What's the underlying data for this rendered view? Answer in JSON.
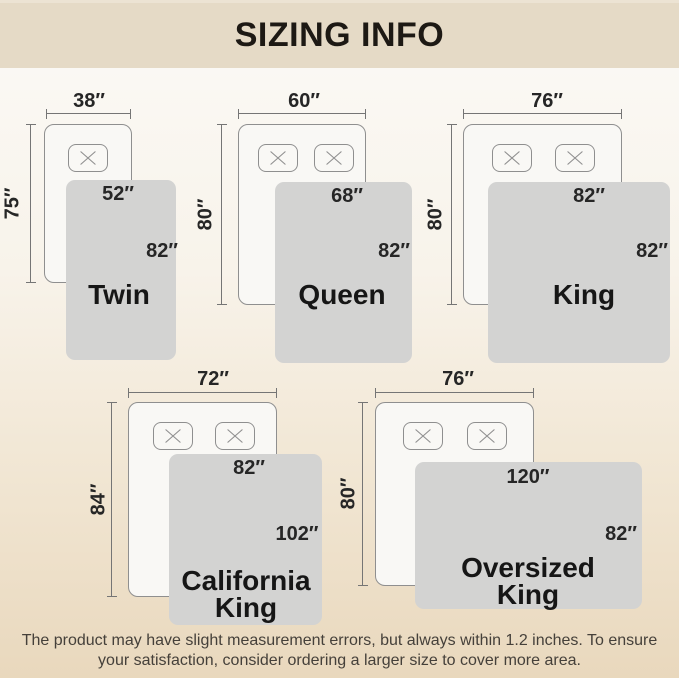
{
  "header": {
    "title": "SIZING INFO"
  },
  "diagrams": [
    {
      "name": "Twin",
      "bed_width": "38″",
      "bed_length": "75″",
      "blanket_width": "52″",
      "blanket_length": "82″",
      "pillow_count": 1
    },
    {
      "name": "Queen",
      "bed_width": "60″",
      "bed_length": "80″",
      "blanket_width": "68″",
      "blanket_length": "82″",
      "pillow_count": 2
    },
    {
      "name": "King",
      "bed_width": "76″",
      "bed_length": "80″",
      "blanket_width": "82″",
      "blanket_length": "82″",
      "pillow_count": 2
    },
    {
      "name": "California King",
      "bed_width": "72″",
      "bed_length": "84″",
      "blanket_width": "82″",
      "blanket_length": "102″",
      "pillow_count": 2
    },
    {
      "name": "Oversized King",
      "bed_width": "76″",
      "bed_length": "80″",
      "blanket_width": "120″",
      "blanket_length": "82″",
      "pillow_count": 2
    }
  ],
  "footer": {
    "disclaimer": "The product may have slight measurement errors, but always within 1.2 inches. To ensure your satisfaction, consider ordering a larger size to cover more area."
  },
  "colors": {
    "header_bg": "#e5dac6",
    "background_top": "#fbfaf7",
    "background_bottom": "#e9d8bd",
    "bed_fill": "#f9f8f5",
    "outline": "#8f8f8f",
    "blanket_fill": "#d3d3d2",
    "text_dark": "#1d1914"
  }
}
